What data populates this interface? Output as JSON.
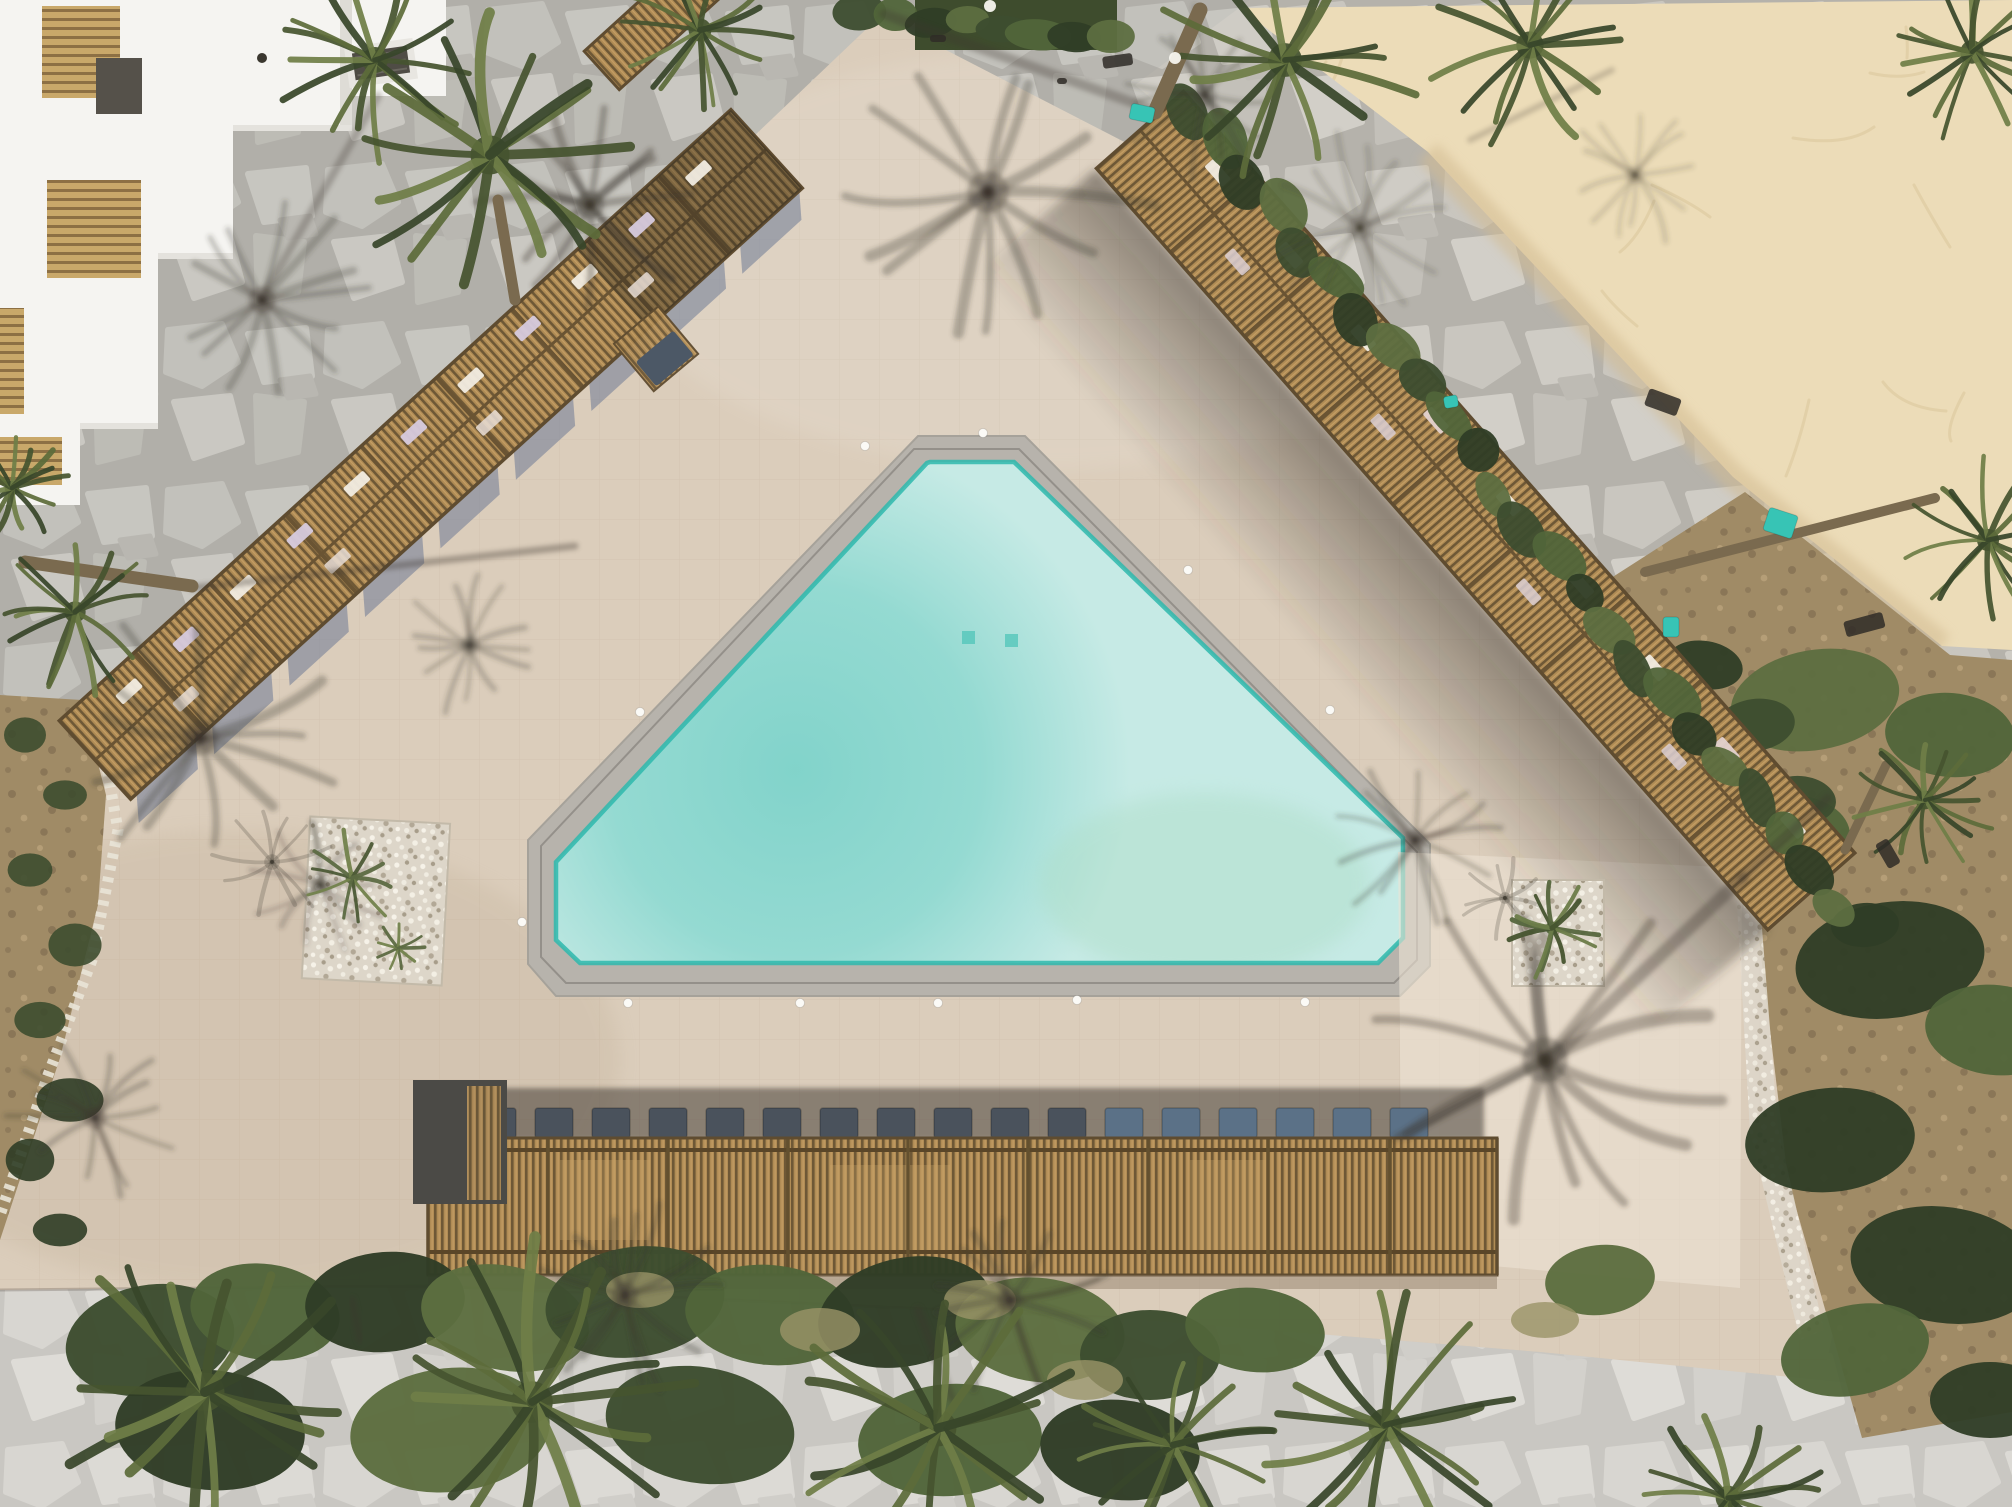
{
  "meta": {
    "title": "Aerial drone photograph: triangular resort pool deck with slatted pergolas, palm trees, stone paths and beach sand",
    "type": "aerial-photograph",
    "visible_text": []
  },
  "palette": {
    "deck": "#dbcdbb",
    "deck_bright": "#ece3d3",
    "deck_shade": "#b4a186",
    "stone_base": "#b5b2ab",
    "stone_light": "#cbc8c1",
    "sand": "#ecdcb8",
    "sand_shade": "#d3bc92",
    "water": "#c6eae5",
    "water_deep": "#7ed2c9",
    "water_edge": "#2eb8ad",
    "water_green_tint": "#abdcc3",
    "coping": "#b7b3ac",
    "coping_joint": "#94908a",
    "wood": "#b08c55",
    "wood_dark": "#6e5836",
    "wood_frame": "#5f4c30",
    "charcoal_roof": "#4b4a46",
    "lounger_slate": "#4a525c",
    "lounger_blue": "#5b7187",
    "pillow_white": "#f1ece1",
    "pillow_lilac": "#d6cade",
    "pillow_pink": "#e3d2cf",
    "hedge_greens": [
      "#3d4d2f",
      "#51653a",
      "#2f3d26",
      "#5d6e40"
    ],
    "palm_greens": [
      "#46542f",
      "#5d6c3a",
      "#38462a",
      "#6f7e47"
    ],
    "dirt": "#a08b66",
    "pebble": "#e9e4d7",
    "building_white": "#f5f4f1",
    "balcony_slat": "#c9a86a",
    "shadow_tone": "rgba(60,54,46,1)",
    "teal_object": "#37c4b5"
  },
  "scene": {
    "palms": [
      {
        "x": 375,
        "y": 60,
        "r": 100,
        "s": 1
      },
      {
        "x": 490,
        "y": 155,
        "r": 150,
        "s": 2
      },
      {
        "x": 700,
        "y": 30,
        "r": 88,
        "s": 3
      },
      {
        "x": 75,
        "y": 612,
        "r": 82,
        "s": 4
      },
      {
        "x": 1285,
        "y": 60,
        "r": 130,
        "s": 5
      },
      {
        "x": 1530,
        "y": 45,
        "r": 105,
        "s": 6
      },
      {
        "x": 1972,
        "y": 52,
        "r": 90,
        "s": 7
      },
      {
        "x": 1988,
        "y": 540,
        "r": 85,
        "s": 8
      },
      {
        "x": 1925,
        "y": 800,
        "r": 72,
        "s": 9
      },
      {
        "x": 205,
        "y": 1392,
        "r": 150,
        "s": 10
      },
      {
        "x": 532,
        "y": 1402,
        "r": 160,
        "s": 11
      },
      {
        "x": 938,
        "y": 1428,
        "r": 142,
        "s": 12
      },
      {
        "x": 1173,
        "y": 1445,
        "r": 100,
        "s": 13
      },
      {
        "x": 1385,
        "y": 1425,
        "r": 128,
        "s": 14
      },
      {
        "x": 1728,
        "y": 1498,
        "r": 95,
        "s": 15
      },
      {
        "x": 12,
        "y": 488,
        "r": 55,
        "s": 16
      }
    ],
    "palm_shadows": [
      {
        "x": 262,
        "y": 300,
        "r": 105,
        "s": 11,
        "o": 0.28
      },
      {
        "x": 200,
        "y": 738,
        "r": 135,
        "s": 5,
        "o": 0.3
      },
      {
        "x": 320,
        "y": 885,
        "r": 70,
        "s": 9,
        "o": 0.24
      },
      {
        "x": 988,
        "y": 192,
        "r": 160,
        "s": 3,
        "o": 0.3
      },
      {
        "x": 1545,
        "y": 1060,
        "r": 175,
        "s": 8,
        "o": 0.33
      },
      {
        "x": 1415,
        "y": 840,
        "r": 85,
        "s": 13,
        "o": 0.28
      },
      {
        "x": 1360,
        "y": 228,
        "r": 95,
        "s": 21,
        "o": 0.18
      },
      {
        "x": 1635,
        "y": 175,
        "r": 70,
        "s": 17,
        "o": 0.16
      },
      {
        "x": 95,
        "y": 1118,
        "r": 85,
        "s": 25,
        "o": 0.28
      },
      {
        "x": 625,
        "y": 1295,
        "r": 100,
        "s": 29,
        "o": 0.3
      },
      {
        "x": 1010,
        "y": 1300,
        "r": 95,
        "s": 31,
        "o": 0.3
      },
      {
        "x": 470,
        "y": 645,
        "r": 70,
        "s": 35,
        "o": 0.25
      },
      {
        "x": 590,
        "y": 205,
        "r": 110,
        "s": 39,
        "o": 0.35
      },
      {
        "x": 1205,
        "y": 95,
        "r": 90,
        "s": 43,
        "o": 0.25
      }
    ],
    "shadow_trunks": [
      [
        192,
        588,
        575,
        546,
        7,
        0.35
      ],
      [
        884,
        14,
        1148,
        108,
        10,
        0.3
      ],
      [
        378,
        96,
        262,
        298,
        8,
        0.28
      ],
      [
        1548,
        1062,
        1742,
        878,
        13,
        0.35
      ],
      [
        1742,
        878,
        1828,
        798,
        9,
        0.3
      ],
      [
        1470,
        140,
        1612,
        70,
        6,
        0.22
      ],
      [
        952,
        1398,
        918,
        1310,
        8,
        0.3
      ],
      [
        360,
        1340,
        352,
        1300,
        7,
        0.3
      ]
    ],
    "trunks": [
      [
        25,
        562,
        192,
        586,
        13
      ],
      [
        1200,
        10,
        1155,
        112,
        15
      ],
      [
        1645,
        572,
        1935,
        498,
        10
      ],
      [
        1845,
        850,
        1886,
        765,
        9
      ],
      [
        515,
        300,
        498,
        200,
        11
      ]
    ],
    "pool_lights": [
      [
        983,
        433
      ],
      [
        865,
        446
      ],
      [
        1188,
        570
      ],
      [
        1330,
        710
      ],
      [
        640,
        712
      ],
      [
        522,
        922
      ],
      [
        628,
        1003
      ],
      [
        800,
        1003
      ],
      [
        938,
        1003
      ],
      [
        1077,
        1000
      ],
      [
        1305,
        1002
      ]
    ],
    "loungers_bottom": {
      "x0": 478,
      "y": 1108,
      "count": 17,
      "pitch": 57,
      "w": 38,
      "h": 30,
      "blue_from": 11
    },
    "hedge_right": {
      "x1": 1192,
      "y1": 108,
      "x2": 1836,
      "y2": 906,
      "count": 24,
      "rx": 27,
      "ry": 17,
      "jit": 10,
      "seed": 51
    },
    "veg_top_chain": {
      "x1": 860,
      "y1": 8,
      "x2": 1110,
      "y2": 42,
      "count": 8,
      "rx": 26,
      "ry": 15,
      "jit": 6,
      "seed": 53
    },
    "planter_top": [
      915,
      0,
      202,
      50
    ],
    "right_bushes": [
      [
        1815,
        700,
        85,
        50,
        -10
      ],
      [
        1950,
        735,
        65,
        42,
        5
      ],
      [
        1790,
        835,
        60,
        40,
        0
      ],
      [
        1890,
        960,
        95,
        58,
        -8
      ],
      [
        1995,
        1030,
        70,
        45,
        6
      ],
      [
        1830,
        1140,
        85,
        52,
        -5
      ],
      [
        1945,
        1265,
        95,
        58,
        8
      ],
      [
        1855,
        1350,
        75,
        45,
        -12
      ],
      [
        1990,
        1400,
        60,
        38,
        0
      ],
      [
        1705,
        665,
        38,
        24,
        10
      ],
      [
        1755,
        725,
        40,
        26,
        -8
      ],
      [
        1800,
        800,
        36,
        24,
        5
      ],
      [
        1865,
        925,
        34,
        22,
        -4
      ]
    ],
    "bottom_veg": [
      [
        150,
        1340,
        85,
        55,
        -10
      ],
      [
        265,
        1312,
        75,
        48,
        8
      ],
      [
        385,
        1302,
        80,
        50,
        -5
      ],
      [
        505,
        1318,
        85,
        52,
        12
      ],
      [
        635,
        1302,
        90,
        55,
        -8
      ],
      [
        770,
        1315,
        85,
        50,
        5
      ],
      [
        905,
        1312,
        88,
        54,
        -12
      ],
      [
        1040,
        1330,
        85,
        52,
        7
      ],
      [
        1150,
        1355,
        70,
        45,
        0
      ],
      [
        1255,
        1330,
        70,
        42,
        6
      ],
      [
        210,
        1430,
        95,
        60,
        5
      ],
      [
        450,
        1430,
        100,
        62,
        -6
      ],
      [
        700,
        1425,
        95,
        58,
        9
      ],
      [
        950,
        1440,
        92,
        56,
        -4
      ],
      [
        1120,
        1450,
        80,
        50,
        6
      ],
      [
        1600,
        1280,
        55,
        35,
        -6
      ]
    ],
    "dry_tufts": [
      [
        820,
        1330,
        40,
        22
      ],
      [
        980,
        1300,
        36,
        20
      ],
      [
        640,
        1290,
        34,
        18
      ],
      [
        1085,
        1380,
        38,
        20
      ],
      [
        1545,
        1320,
        34,
        18
      ]
    ],
    "left_tufts": [
      [
        25,
        735
      ],
      [
        65,
        795
      ],
      [
        30,
        870
      ],
      [
        75,
        945
      ],
      [
        40,
        1020
      ],
      [
        70,
        1100
      ],
      [
        30,
        1160
      ],
      [
        60,
        1230
      ]
    ],
    "teal_objects": [
      [
        1770,
        507,
        30,
        24,
        18
      ],
      [
        1663,
        617,
        16,
        20,
        0
      ],
      [
        1443,
        397,
        14,
        12,
        -10
      ],
      [
        1132,
        103,
        24,
        16,
        12
      ]
    ],
    "dark_objects": [
      [
        1102,
        57,
        30,
        12,
        -8
      ],
      [
        1650,
        388,
        34,
        18,
        20
      ],
      [
        1843,
        622,
        40,
        16,
        -15
      ],
      [
        1887,
        838,
        28,
        14,
        60
      ],
      [
        1057,
        78,
        10,
        6,
        0
      ],
      [
        930,
        35,
        16,
        7,
        0
      ]
    ],
    "white_dots": [
      [
        1175,
        58
      ],
      [
        990,
        6
      ]
    ],
    "sand_squiggles": {
      "count": 28,
      "seed": 77,
      "x1": 1300,
      "y1": 10,
      "x2": 1995,
      "y2": 640
    },
    "pillows_left_upper": [
      58,
      135,
      212,
      289,
      366,
      443,
      520,
      597,
      674,
      751,
      828
    ],
    "pillows_left_lower": [
      95,
      300,
      505,
      710
    ],
    "pillows_right_upper": [
      70,
      180,
      290,
      400,
      510,
      620,
      730,
      840,
      940
    ],
    "pillows_right_lower": [
      150,
      370,
      590,
      810
    ],
    "pergola_left": {
      "tx": 95,
      "ty": 760,
      "rot": -42.3,
      "len": 908,
      "w": 106
    },
    "pergola_right": {
      "tx": 1140,
      "ty": 130,
      "rot": 48.6,
      "len": 1015,
      "w": 116
    },
    "shadow_strips_left": {
      "count": 9,
      "start": 8,
      "step": 102
    }
  }
}
